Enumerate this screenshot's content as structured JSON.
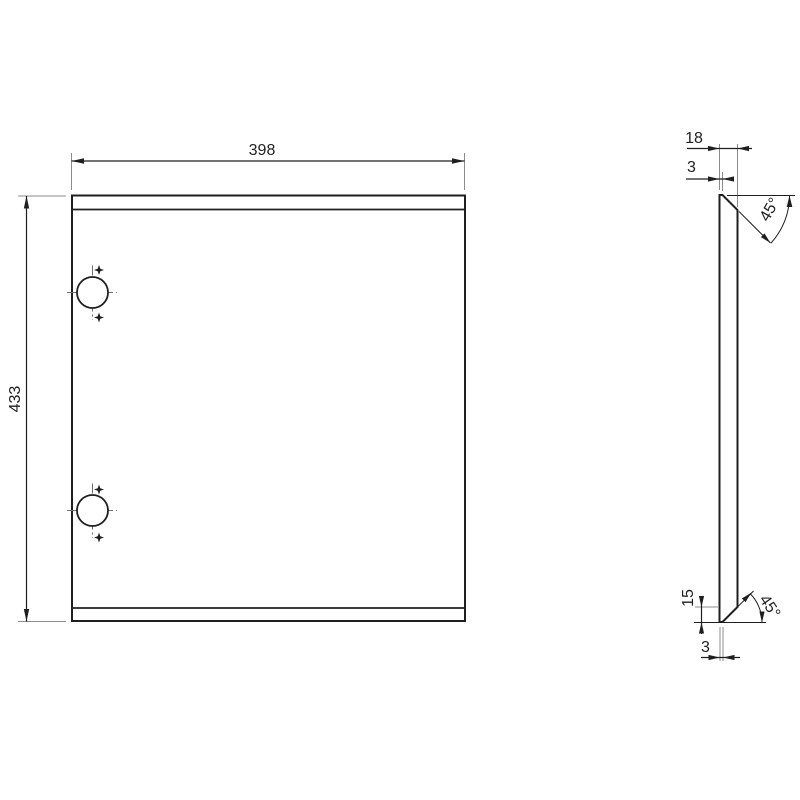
{
  "drawing": {
    "type": "2d-technical-drawing",
    "views": [
      "front-view",
      "side-view"
    ],
    "front_view": {
      "width_label": "398",
      "height_label": "433",
      "hole_count": 2
    },
    "side_view": {
      "thickness_label": "18",
      "top_flat_label": "3",
      "top_angle_label": "45°",
      "chamfer_height_label": "15",
      "bottom_flat_label": "3",
      "bottom_angle_label": "45°"
    },
    "colors": {
      "background": "#ffffff",
      "part_line": "#1f1f1f",
      "dimension_line": "#1f1f1f",
      "extension_line": "#8c8c8c",
      "centerline": "#6e6e6e"
    }
  }
}
